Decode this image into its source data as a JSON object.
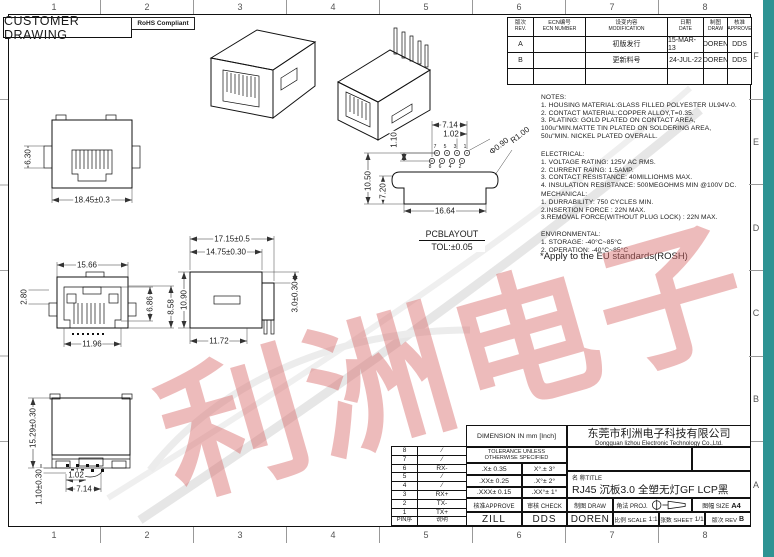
{
  "page": {
    "outer_bg": "#2e9393",
    "sheet_bg": "#ffffff",
    "line_color": "#1b1b1b",
    "watermark_text": "利洲电子",
    "watermark_color": "#d96a6a"
  },
  "header": {
    "customer_drawing": "CUSTOMER DRAWING",
    "rohs": "RoHS Compliant"
  },
  "grid_refs": {
    "top": [
      "1",
      "2",
      "3",
      "4",
      "5",
      "6",
      "7",
      "8"
    ],
    "bottom": [
      "1",
      "2",
      "3",
      "4",
      "5",
      "6",
      "7",
      "8"
    ],
    "right": [
      "F",
      "E",
      "D",
      "C",
      "B",
      "A"
    ]
  },
  "revision_table": {
    "col_headers": [
      {
        "zh": "版次",
        "en": "REV."
      },
      {
        "zh": "ECN编号",
        "en": "ECN NUMBER"
      },
      {
        "zh": "设变内容",
        "en": "MODIFICATION"
      },
      {
        "zh": "日期",
        "en": "DATE"
      },
      {
        "zh": "制图",
        "en": "DRAW"
      },
      {
        "zh": "核准",
        "en": "APPROVE"
      }
    ],
    "rows": [
      {
        "rev": "A",
        "ecn": "",
        "mod": "初版发行",
        "date": "15-MAR-13",
        "draw": "DOREN",
        "approve": "DDS"
      },
      {
        "rev": "B",
        "ecn": "",
        "mod": "更新料号",
        "date": "24-JUL-22",
        "draw": "DOREN",
        "approve": "DDS"
      },
      {
        "rev": "",
        "ecn": "",
        "mod": "",
        "date": "",
        "draw": "",
        "approve": ""
      }
    ]
  },
  "notes": {
    "notes": "NOTES:\n1. HOUSING MATERIAL:GLASS FILLED POLYESTER UL94V-0.\n2. CONTACT MATERIAL:COPPER ALLOY,T=0.35.\n3. PLATING:  GOLD PLATED ON CONTACT AREA,\n   100u\"MIN.MATTE TIN PLATED ON SOLDERING AREA,\n   50u\"MIN. NICKEL PLATED OVERALL.",
    "electrical": "ELECTRICAL:\n1. VOLTAGE RATING: 125V AC RMS.\n2. CURRENT RAING: 1.5AMP.\n3. CONTACT RESISTANCE: 40MILLIOHMS MAX.\n4. INSULATION RESISTANCE: 500MEGOHMS MIN @100V DC.",
    "mechanical": "MECHANICAL:\n1. DURRABILITY: 750 CYCLES MIN.\n2.INSERTION FORCE : 22N MAX.\n3.REMOVAL FORCE(WITHOUT PLUG LOCK) : 22N MAX.",
    "environmental": "ENVIRONMENTAL:\n1. STORAGE: -40°C~85°C\n2. OPERATION: -40°C~85°C",
    "eu": "*Apply to the EU standards(ROSH)"
  },
  "dims": {
    "front_h": "6.30",
    "front_w": "18.45±0.3",
    "face_w": "15.66",
    "face_left": "2.80",
    "face_h1": "6.86",
    "face_h2": "8.58",
    "face_inner_w": "11.96",
    "side_total": "17.15±0.5",
    "side_body": "14.75±0.30",
    "side_h": "10.90",
    "side_sink": "3.0±0.30",
    "side_bottom": "11.72",
    "bot_h": "15.29±0.30",
    "bot_pin": "1.10±0.30",
    "bot_pitch": "1.02",
    "bot_row": "7.14",
    "pcb_row": "7.14",
    "pcb_pitch": "1.02",
    "pcb_gap": "1.10",
    "pcb_hole": "Φ0.90",
    "pcb_r": "R1.00",
    "pcb_h1": "10.50",
    "pcb_h2": "7.20",
    "pcb_w": "16.64"
  },
  "pcb": {
    "label": "PCBLAYOUT",
    "tol": "TOL:±0.05",
    "pins_top": [
      "7",
      "5",
      "3",
      "1"
    ],
    "pins_bottom": [
      "8",
      "6",
      "4",
      "2"
    ]
  },
  "pin_table": {
    "rows": [
      {
        "pin": "8",
        "desc": "∕"
      },
      {
        "pin": "7",
        "desc": "∕"
      },
      {
        "pin": "6",
        "desc": "RX-"
      },
      {
        "pin": "5",
        "desc": "∕"
      },
      {
        "pin": "4",
        "desc": "∕"
      },
      {
        "pin": "3",
        "desc": "RX+"
      },
      {
        "pin": "2",
        "desc": "TX-"
      },
      {
        "pin": "1",
        "desc": "TX+"
      }
    ],
    "footer": {
      "pin": "PIN序",
      "desc": "说明"
    }
  },
  "title_block": {
    "dimension_in": "DIMENSION IN mm [Inch]",
    "company_zh": "东莞市利洲电子科技有限公司",
    "company_en": "Dongguan lizhou Electronic Technology Co.,Ltd.",
    "tolerance_header": "TOLERANCE UNLESS\nOTHERWISE SPECIFIED",
    "tol_r1_l": ".X± 0.35",
    "tol_r1_r": "X°.± 3°",
    "tol_r2_l": ".XX± 0.25",
    "tol_r2_r": ".X°± 2°",
    "tol_r3_l": ".XXX± 0.15",
    "tol_r3_r": ".XX°± 1°",
    "title_label": "名 称TITLE",
    "title_value": "RJ45 沉板3.0 全塑无灯GF LCP黑",
    "approve_label": "核准APPROVE",
    "check_label": "审核 CHECK",
    "draw_label": "制图 DRAW",
    "proj_label": "角法 PROJ.",
    "size_label": "图幅 SIZE",
    "size_value": "A4",
    "approve_value": "ZILL",
    "check_value": "DDS",
    "draw_value": "DOREN",
    "scale_label": "比例 SCALE",
    "scale_value": "1:1",
    "sheet_label": "张数 SHEET",
    "sheet_value": "1/1",
    "rev_label": "版次 REV",
    "rev_value": "B"
  }
}
